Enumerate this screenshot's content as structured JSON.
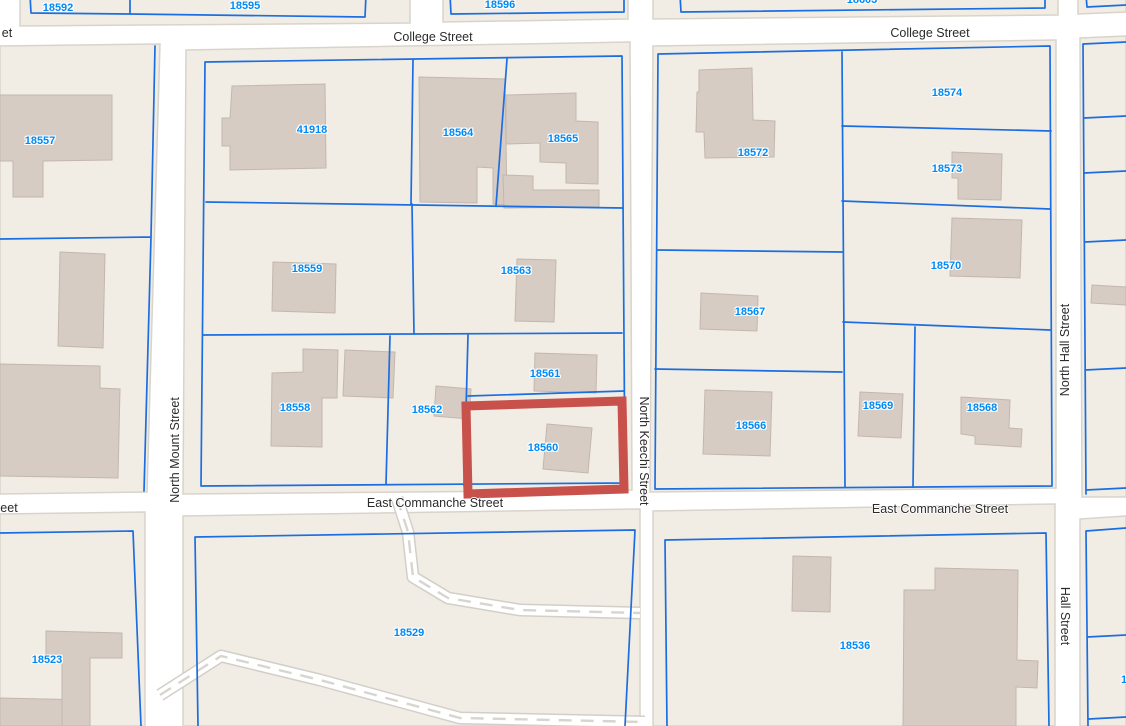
{
  "map": {
    "kind": "parcel-map",
    "streets": {
      "college_street": "College Street",
      "east_commanche_street": "East Commanche Street",
      "north_mount_street": "North Mount Street",
      "north_keechi_street": "North Keechi Street",
      "north_hall_street": "North Hall Street",
      "hall_street": "Hall Street",
      "partial_top_left": "et",
      "partial_bottom_left": "eet"
    },
    "parcels": {
      "18592": "18592",
      "18595": "18595",
      "18596": "18596",
      "18603": "18603",
      "18557": "18557",
      "41918": "41918",
      "18564": "18564",
      "18565": "18565",
      "18559": "18559",
      "18563": "18563",
      "18558": "18558",
      "18562": "18562",
      "18561": "18561",
      "18560": "18560",
      "18572": "18572",
      "18574": "18574",
      "18573": "18573",
      "18570": "18570",
      "18567": "18567",
      "18566": "18566",
      "18569": "18569",
      "18568": "18568",
      "18523": "18523",
      "18529": "18529",
      "18536": "18536",
      "partial_right": "1"
    },
    "highlight": {
      "parcel_id": "18560",
      "color": "#c9514b"
    },
    "colors": {
      "street": "#ffffff",
      "block_fill": "#f1ede4",
      "block_edge": "#d8d4cb",
      "parcel_line": "#1c6ee0",
      "building_fill": "#d7ccc4",
      "building_edge": "#c3b7ad",
      "parcel_label": "#008af5",
      "street_label": "#2b2b2b"
    }
  }
}
